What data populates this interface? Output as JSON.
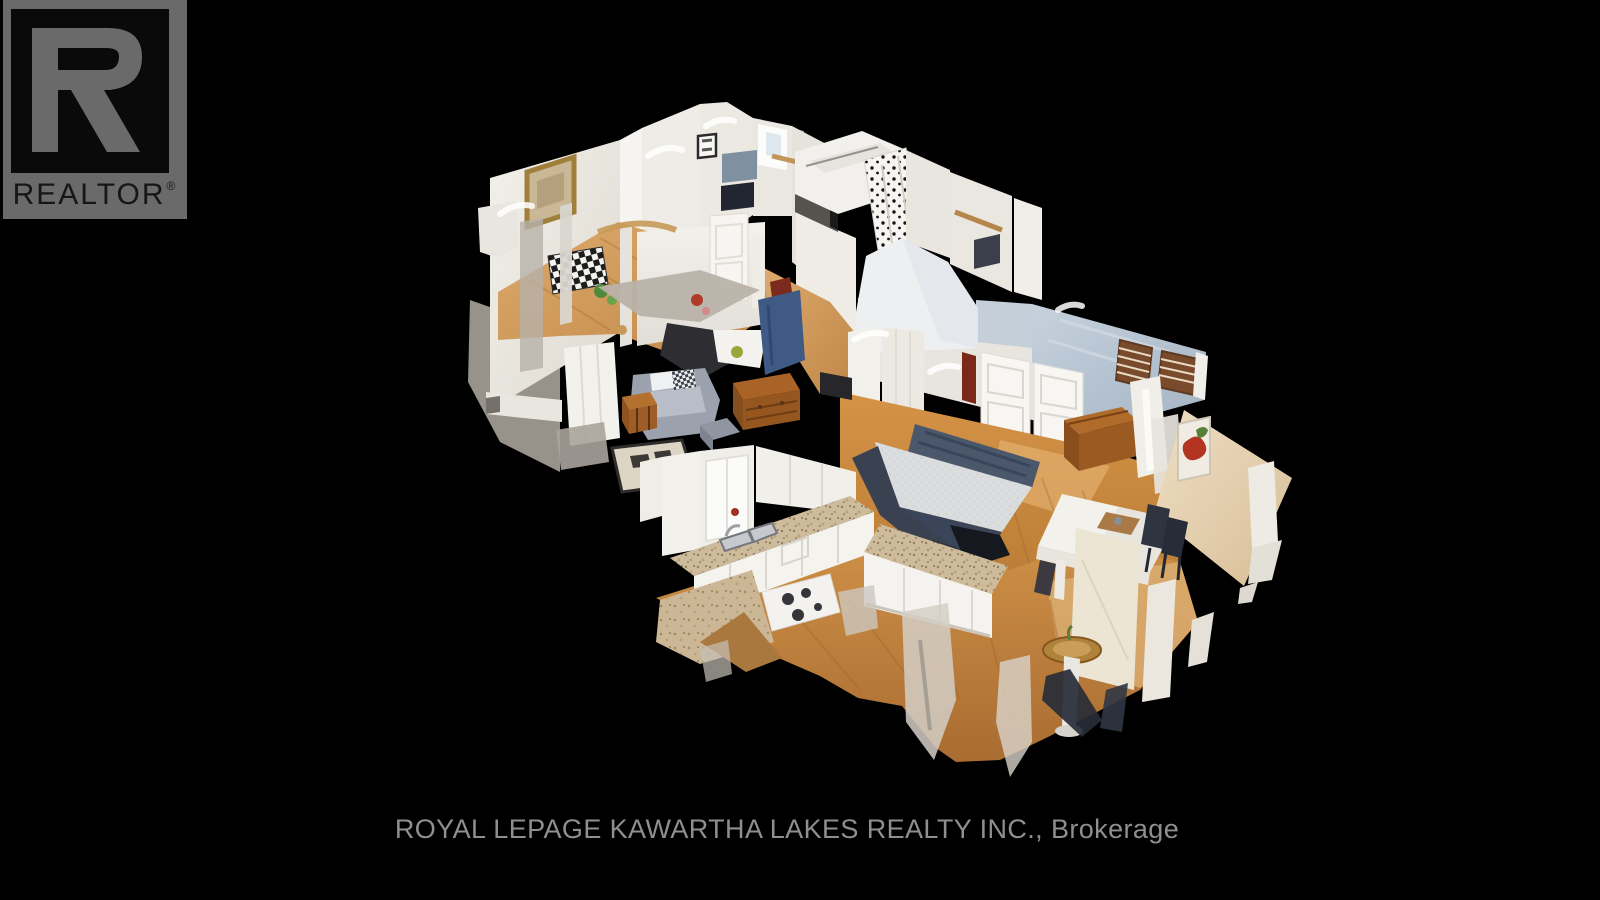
{
  "window": {
    "width": 1600,
    "height": 900,
    "background_color": "#000000"
  },
  "logo": {
    "text": "REALTOR",
    "registered_symbol": "®",
    "glyph": "R",
    "panel_color": "#6a6a6a",
    "inner_square_color": "#0a0a0a",
    "glyph_color": "#6a6a6a",
    "text_color": "#161616"
  },
  "footer": {
    "brokerage_line": "ROYAL LEPAGE KAWARTHA LAKES REALTY INC., Brokerage",
    "text_color": "#8f8f8f"
  },
  "scene": {
    "type": "3d-dollhouse-cutaway",
    "description": "Overhead dollhouse view of a scanned home interior with cut-away walls on a black background",
    "rooms": [
      "upper bedroom",
      "hallway",
      "living area",
      "bathroom",
      "master bedroom",
      "kitchen",
      "dining area"
    ],
    "furniture": [
      "gold framed painting",
      "checkered blanket",
      "gray armchair",
      "area rug",
      "storage trunk",
      "wooden dresser",
      "bathtub",
      "spotted shower curtain",
      "paneled closet doors",
      "bed with navy blanket",
      "wooden blanket chest",
      "louvered wood shutters",
      "double kitchen sink",
      "cooktop",
      "kitchen island",
      "dining table with white cloth",
      "dark dining chairs",
      "round pedestal table",
      "red floral artwork"
    ],
    "palette": {
      "wall": "#f0ede8",
      "wall_shadow": "#dcd8d1",
      "ceiling_slope_blue": "#b7c5d2",
      "floor_light_wood": "#d8a86c",
      "floor_warm_wood": "#c8893c",
      "mattress": "#d9dbdd",
      "bedding_navy": "#4b576b",
      "cabinet_white": "#f4f2ee",
      "countertop_speckle": "#cdbb9c",
      "furniture_wood": "#a86328",
      "armchair_gray": "#9ba1ad",
      "rug": "#ddd5c4",
      "art_red": "#b33420",
      "shutter_wood": "#7a4a2c"
    }
  }
}
